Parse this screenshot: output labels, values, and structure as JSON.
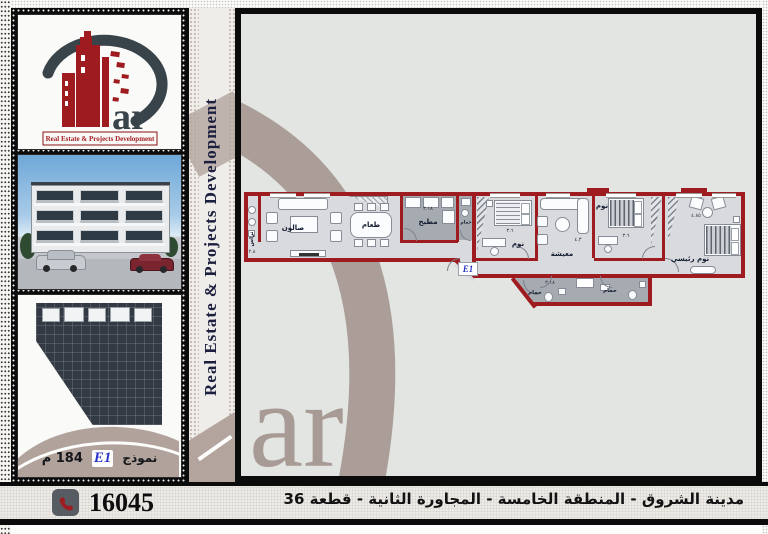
{
  "side_band": {
    "text": "Real Estate & Projects Development"
  },
  "logo": {
    "suffix": "ar",
    "tagline": "Real Estate & Projects Development",
    "brand_red": "#9e1c20",
    "brand_dark": "#39434a"
  },
  "watermark": {
    "text": "ar",
    "color": "#a89a95"
  },
  "model_panel": {
    "model_label": "نموذج",
    "model_code": "E1",
    "area_value": "184",
    "area_unit": "م"
  },
  "floor_plan": {
    "unit_badge": "E1",
    "wall_color": "#9e1c20",
    "rooms": [
      {
        "id": "terrace",
        "label": "تراس",
        "dim": "٢.٨"
      },
      {
        "id": "salon",
        "label": "صالون",
        "dim": ""
      },
      {
        "id": "dining",
        "label": "طعام",
        "dim": ""
      },
      {
        "id": "kitchen",
        "label": "مطبخ",
        "dim": "٣.١٨"
      },
      {
        "id": "bath-small",
        "label": "حمام",
        "dim": ""
      },
      {
        "id": "bedroom-1",
        "label": "نوم",
        "dim": "٣.٦"
      },
      {
        "id": "living",
        "label": "معيشة",
        "dim": "٤.٣"
      },
      {
        "id": "bedroom-2",
        "label": "نوم",
        "dim": "٣.٦"
      },
      {
        "id": "master-bedroom",
        "label": "نوم رئيسي",
        "dim": "٤.٨٥"
      },
      {
        "id": "bath-2",
        "label": "حمام",
        "dim": "٣.١٨"
      },
      {
        "id": "bath-3",
        "label": "حمام",
        "dim": ""
      }
    ]
  },
  "footer": {
    "phone": "16045",
    "address": "مدينة الشروق - المنطقة الخامسة - المجاورة الثانية - قطعة 36"
  }
}
